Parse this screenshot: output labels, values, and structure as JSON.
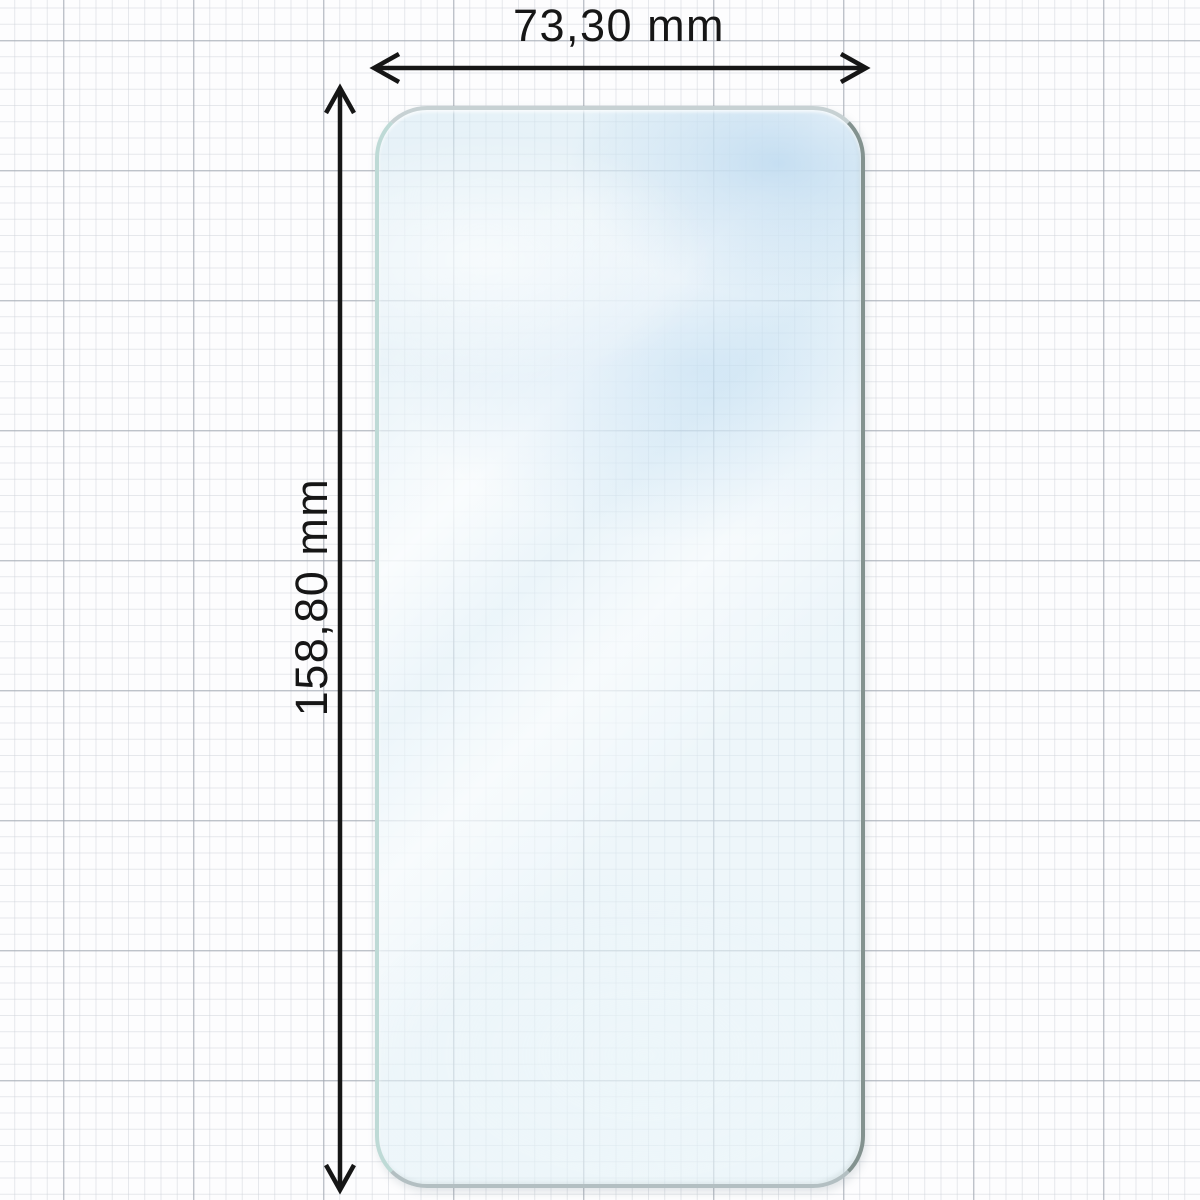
{
  "diagram": {
    "subject": "phone screen protector film on graph paper",
    "width_dimension": {
      "label": "73,30 mm",
      "value": "73,30"
    },
    "height_dimension": {
      "label": "158,80 mm",
      "value": "158,80"
    },
    "unit": "mm"
  },
  "icons": {
    "width_arrow": "double-headed-horizontal-arrow",
    "height_arrow": "double-headed-vertical-arrow"
  },
  "colors": {
    "ink": "#161616",
    "paper": "#fdfdfe",
    "grid_minor": "#ced2d9",
    "grid_major": "#9ea4ae",
    "glass_tint": "#dcecf5",
    "glass_edge_dark": "#83928f",
    "glass_edge_light": "#bedad6"
  }
}
